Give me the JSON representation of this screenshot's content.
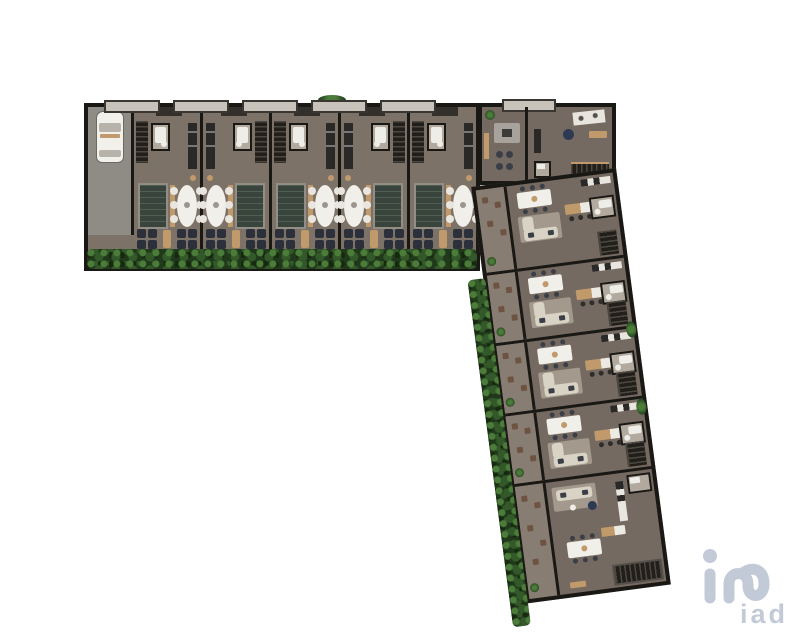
{
  "meta": {
    "view": "aerial-3d-floorplan-render",
    "background": "#ffffff",
    "shape": "L-shaped residential development"
  },
  "watermark": {
    "label": "iad",
    "color": "#c3cad7"
  },
  "palette": {
    "wall": "#1a1815",
    "floor": "#756a61",
    "floor_light": "#887d72",
    "terrace": "#7d7268",
    "driveway": "#8f8c86",
    "pool": "#39443c",
    "pool_rim": "#928d85",
    "table_white": "#f1efe9",
    "chair_white": "#e8e6df",
    "lounger_dark": "#2c303b",
    "wood": "#c09a6a",
    "hedge_dark": "#20391b",
    "hedge_mid": "#33582a",
    "hedge_light": "#4c7c39",
    "sofa": "#d9d3c5",
    "stairs": "#221f1b",
    "stair_tread": "#4c4841",
    "bath_floor": "#b2aa9e",
    "fixture_white": "#efede8",
    "counter_dark": "#2b2927",
    "counter_white": "#e9e6df",
    "cushion": "#3a3e47",
    "pouf_blue": "#2e3953",
    "island_gray": "#a7a39c",
    "stool_brown": "#6e5342",
    "car_white": "#f2f0ea",
    "car_glass": "#b7b2aa"
  },
  "top_wing": {
    "unit_count": 5,
    "units": [
      {
        "mirror": false
      },
      {
        "mirror": true
      },
      {
        "mirror": false
      },
      {
        "mirror": true
      },
      {
        "mirror": false
      }
    ],
    "features": [
      "driveway",
      "parked-car",
      "plunge-pool",
      "oval-dining-table",
      "sun-loungers",
      "hedge-row"
    ]
  },
  "corner_block": {
    "rooms": [
      "kitchen-island-room",
      "studio-room-with-desk-and-stairs"
    ]
  },
  "right_wing": {
    "tilt_deg": -7.5,
    "unit_count": 5,
    "units": [
      {
        "type": "standard"
      },
      {
        "type": "standard"
      },
      {
        "type": "standard"
      },
      {
        "type": "standard"
      },
      {
        "type": "end"
      }
    ],
    "features": [
      "side-terrace",
      "dining-table",
      "kitchen-island",
      "l-shaped-sofa",
      "bathroom",
      "staircase",
      "hedge-row"
    ]
  }
}
